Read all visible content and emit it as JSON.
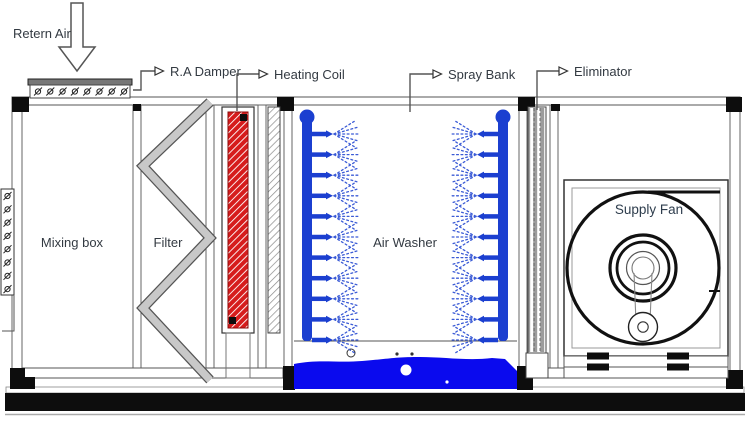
{
  "title": "Air Handling Unit sectional diagram",
  "labels": {
    "return_air": "Retern Air",
    "ra_damper": "R.A Damper",
    "heating_coil": "Heating Coil",
    "spray_bank": "Spray Bank",
    "eliminator": "Eliminator"
  },
  "sections": {
    "mixing_box": "Mixing box",
    "filter": "Filter",
    "air_washer": "Air Washer",
    "supply_fan": "Supply Fan"
  },
  "colors": {
    "coil_red": "#d61c1c",
    "pipe_blue": "#1b3fd0",
    "spray_blue": "#3b5bd6",
    "water_blue": "#0a0aee",
    "filter_gray": "#c8c8c8",
    "outline_dark": "#333333"
  },
  "spray": {
    "banks": 2,
    "nozzles_per_bank": 11
  }
}
